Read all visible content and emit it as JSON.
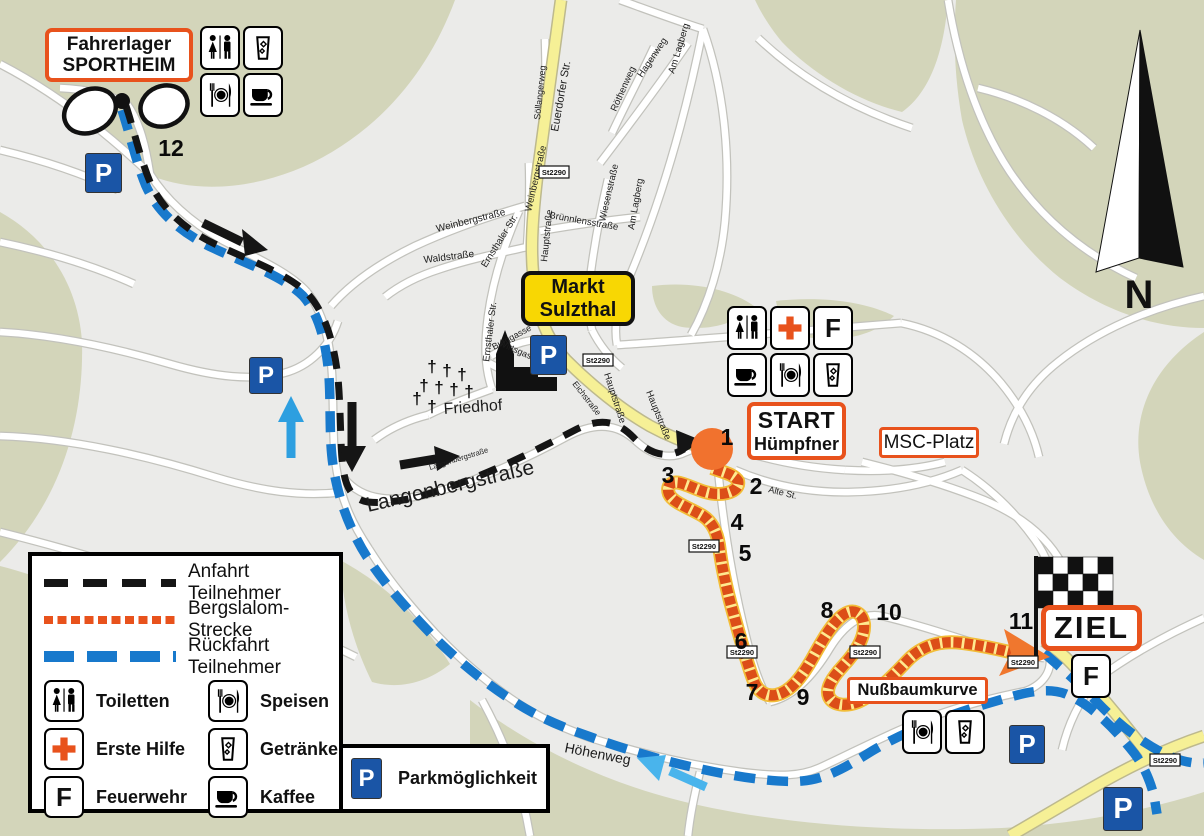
{
  "map": {
    "colors": {
      "background": "#ebebe9",
      "green_area": "#d3d5ba",
      "accent_orange": "#e8521c",
      "course_orange": "#dc4e18",
      "route_blue": "#1879cc",
      "route_black": "#151515",
      "main_road_yellow": "#f6f096",
      "town_sign_yellow": "#f8d703",
      "parking_blue": "#1a55a6"
    },
    "compass_label": "N",
    "glyphs": {
      "parking": "P",
      "fire": "F",
      "cross_marker": "†"
    },
    "road_badge_text": "St2290",
    "boxes": {
      "fahrerlager": {
        "line1": "Fahrerlager",
        "line2": "SPORTHEIM"
      },
      "markt": {
        "line1": "Markt",
        "line2": "Sulzthal"
      },
      "start": {
        "line1": "START",
        "line2": "Hümpfner"
      },
      "msc": {
        "label": "MSC-Platz"
      },
      "ziel": {
        "label": "ZIEL"
      },
      "nussbaum": {
        "label": "Nußbaumkurve"
      }
    },
    "course_numbers": [
      {
        "n": "1",
        "x": 727,
        "y": 437
      },
      {
        "n": "2",
        "x": 756,
        "y": 486
      },
      {
        "n": "3",
        "x": 668,
        "y": 475
      },
      {
        "n": "4",
        "x": 737,
        "y": 522
      },
      {
        "n": "5",
        "x": 745,
        "y": 553
      },
      {
        "n": "6",
        "x": 741,
        "y": 641
      },
      {
        "n": "7",
        "x": 752,
        "y": 692
      },
      {
        "n": "8",
        "x": 827,
        "y": 610
      },
      {
        "n": "9",
        "x": 803,
        "y": 697
      },
      {
        "n": "10",
        "x": 889,
        "y": 612
      },
      {
        "n": "11",
        "x": 1021,
        "y": 621
      },
      {
        "n": "12",
        "x": 171,
        "y": 148
      }
    ],
    "street_labels": [
      {
        "text": "Euerdorfer Str.",
        "x": 558,
        "y": 132,
        "rot": -80,
        "size": 11
      },
      {
        "text": "Söllangerweg",
        "x": 540,
        "y": 120,
        "rot": -84,
        "size": 9
      },
      {
        "text": "Röthenweg",
        "x": 616,
        "y": 112,
        "rot": -66,
        "size": 9.5
      },
      {
        "text": "Hagenweg",
        "x": 642,
        "y": 78,
        "rot": -56,
        "size": 9.5
      },
      {
        "text": "Am Lagberg",
        "x": 674,
        "y": 74,
        "rot": -73,
        "size": 9.5
      },
      {
        "text": "Am Lagberg",
        "x": 634,
        "y": 230,
        "rot": -80,
        "size": 9.5
      },
      {
        "text": "Wiesenstraße",
        "x": 605,
        "y": 222,
        "rot": -77,
        "size": 9.5
      },
      {
        "text": "Brünnlensstraße",
        "x": 549,
        "y": 218,
        "rot": 10,
        "size": 9.5
      },
      {
        "text": "Weinbergstraße",
        "x": 437,
        "y": 232,
        "rot": -14,
        "size": 10
      },
      {
        "text": "Weinbergstraße",
        "x": 531,
        "y": 212,
        "rot": -77,
        "size": 9.5
      },
      {
        "text": "Waldstraße",
        "x": 424,
        "y": 263,
        "rot": -7,
        "size": 10
      },
      {
        "text": "Ernsthaler Str.",
        "x": 486,
        "y": 268,
        "rot": -58,
        "size": 9.5
      },
      {
        "text": "Ernsthaler Str.",
        "x": 489,
        "y": 362,
        "rot": -83,
        "size": 9.5
      },
      {
        "text": "Wirtsgasse",
        "x": 498,
        "y": 345,
        "rot": 24,
        "size": 9
      },
      {
        "text": "Burggasse",
        "x": 494,
        "y": 350,
        "rot": -28,
        "size": 9
      },
      {
        "text": "Hauptstraße",
        "x": 547,
        "y": 262,
        "rot": -84,
        "size": 9.5
      },
      {
        "text": "Hauptstraße",
        "x": 604,
        "y": 374,
        "rot": 72,
        "size": 9.5
      },
      {
        "text": "Hauptstraße",
        "x": 646,
        "y": 392,
        "rot": 68,
        "size": 9.5
      },
      {
        "text": "Eichstraße",
        "x": 572,
        "y": 384,
        "rot": 52,
        "size": 8.5
      },
      {
        "text": "Friedhof",
        "x": 444,
        "y": 414,
        "rot": -4,
        "size": 16
      },
      {
        "text": "Langenbergstraße",
        "x": 368,
        "y": 512,
        "rot": -13,
        "size": 21
      },
      {
        "text": "Langenbergstraße",
        "x": 430,
        "y": 470,
        "rot": -17,
        "size": 7.5
      },
      {
        "text": "Alte St.",
        "x": 768,
        "y": 492,
        "rot": 14,
        "size": 9
      },
      {
        "text": "Höhenweg",
        "x": 564,
        "y": 752,
        "rot": 11,
        "size": 14
      }
    ],
    "road_badges": [
      {
        "x": 554,
        "y": 172
      },
      {
        "x": 598,
        "y": 360
      },
      {
        "x": 704,
        "y": 546
      },
      {
        "x": 742,
        "y": 652
      },
      {
        "x": 865,
        "y": 652
      },
      {
        "x": 1023,
        "y": 662
      },
      {
        "x": 1165,
        "y": 760
      }
    ],
    "parking_signs": [
      {
        "x": 85,
        "y": 153,
        "s": 40
      },
      {
        "x": 249,
        "y": 357,
        "s": 37
      },
      {
        "x": 530,
        "y": 335,
        "s": 40
      },
      {
        "x": 1009,
        "y": 725,
        "s": 39
      },
      {
        "x": 1103,
        "y": 787,
        "s": 44
      }
    ],
    "icon_panels": [
      {
        "name": "fahrerlager-services",
        "x": 200,
        "y": 26,
        "cols": 2,
        "icons": [
          "wc",
          "drink",
          "food",
          "coffee"
        ]
      },
      {
        "name": "start-services",
        "x": 727,
        "y": 306,
        "cols": 3,
        "icons": [
          "wc",
          "cross",
          "f",
          "coffee",
          "food",
          "drink"
        ]
      },
      {
        "name": "nussbaum-services",
        "x": 902,
        "y": 710,
        "cols": 2,
        "icons": [
          "food",
          "drink"
        ]
      },
      {
        "name": "ziel-fire",
        "x": 1071,
        "y": 654,
        "cols": 1,
        "icons": [
          "f"
        ]
      }
    ],
    "friedhof_crosses": [
      [
        432,
        372
      ],
      [
        447,
        376
      ],
      [
        462,
        380
      ],
      [
        424,
        391
      ],
      [
        439,
        393
      ],
      [
        454,
        395
      ],
      [
        469,
        397
      ],
      [
        417,
        404
      ],
      [
        432,
        412
      ]
    ]
  },
  "legend": {
    "lines": [
      {
        "type": "anfahrt",
        "label": "Anfahrt Teilnehmer"
      },
      {
        "type": "strecke",
        "label": "Bergslalom-Strecke"
      },
      {
        "type": "rueckfahrt",
        "label": "Rückfahrt Teilnehmer"
      }
    ],
    "items": [
      {
        "icon": "wc",
        "label": "Toiletten"
      },
      {
        "icon": "food",
        "label": "Speisen"
      },
      {
        "icon": "cross",
        "label": "Erste Hilfe"
      },
      {
        "icon": "drink",
        "label": "Getränke"
      },
      {
        "icon": "f",
        "label": "Feuerwehr"
      },
      {
        "icon": "coffee",
        "label": "Kaffee"
      }
    ],
    "parking_label": "Parkmöglichkeit"
  }
}
